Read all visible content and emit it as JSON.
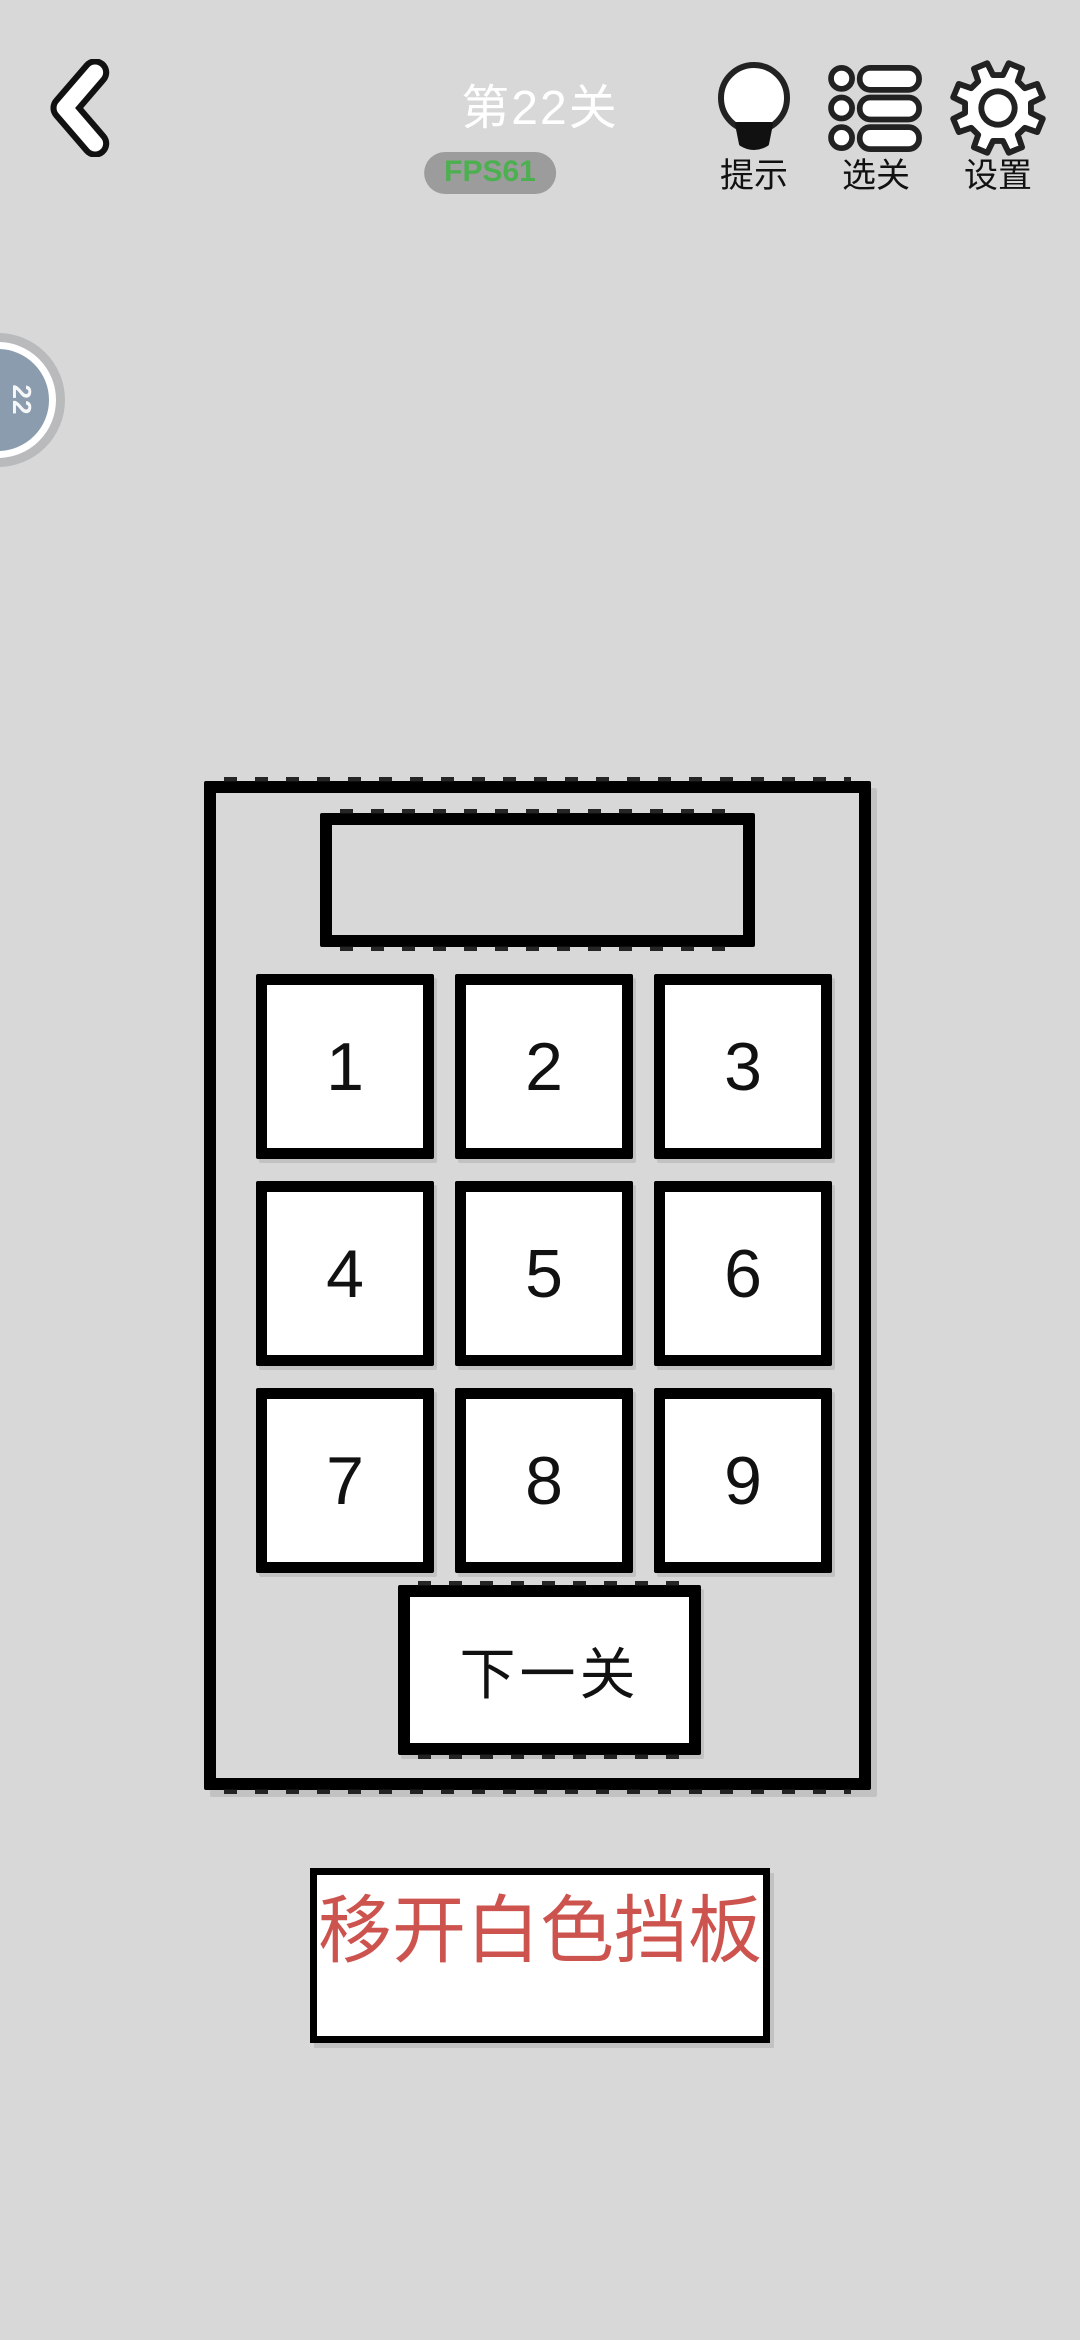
{
  "header": {
    "title": "第22关",
    "fps_badge": "FPS61",
    "actions": [
      {
        "id": "hint",
        "label": "提示"
      },
      {
        "id": "levels",
        "label": "选关"
      },
      {
        "id": "settings",
        "label": "设置"
      }
    ]
  },
  "side_badge": {
    "text": "22"
  },
  "calculator": {
    "display_value": "",
    "keys": [
      "1",
      "2",
      "3",
      "4",
      "5",
      "6",
      "7",
      "8",
      "9"
    ],
    "next_button_label": "下一关"
  },
  "hint": {
    "text": "移开白色挡板"
  },
  "colors": {
    "background": "#d8d8d8",
    "border_black": "#000000",
    "title_text": "#ffffff",
    "fps_text": "#4caf50",
    "fps_badge_bg": "#7d7d7d",
    "hint_text_red": "#cd544e",
    "side_badge_fill": "#8a9cae",
    "key_fill": "#ffffff"
  }
}
